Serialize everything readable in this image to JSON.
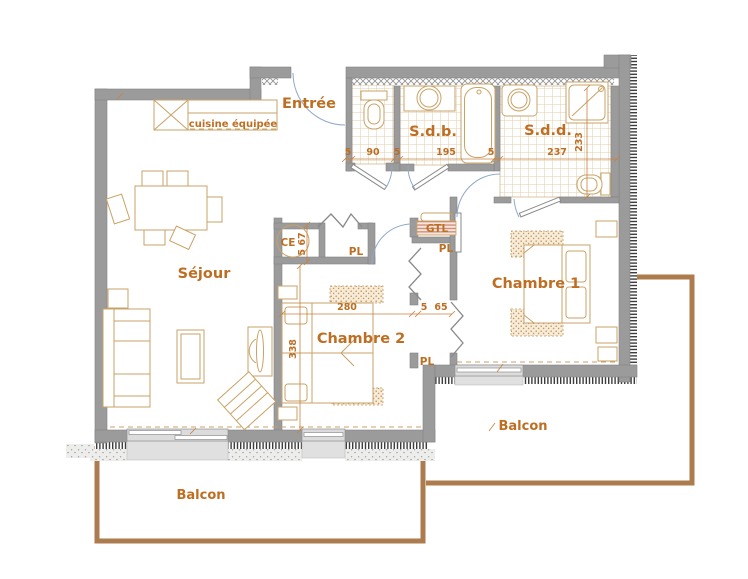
{
  "plan_type": "apartment-floor-plan",
  "colors": {
    "wall": "#9B9B9B",
    "label_text": "#BE6E22",
    "furniture_line": "#C9A265",
    "balcony_line": "#AC7C4E",
    "door_arc": "#8FA8CC",
    "tile_line": "#E3CDAA",
    "window_fill": "#DCDCDC"
  },
  "labels": {
    "entree": "Entrée",
    "sdb": "S.d.b.",
    "sdd": "S.d.d.",
    "sejour": "Séjour",
    "chambre1": "Chambre 1",
    "chambre2": "Chambre 2",
    "balcon_south": "Balcon",
    "balcon_east": "Balcon",
    "kitchen": "cuisine équipée",
    "ce": "CE",
    "gtl": "GTL",
    "pl_hall": "PL",
    "pl_mid": "PL",
    "pl_low": "PL"
  },
  "dimensions_cm": {
    "wc": [
      "5",
      "90",
      "5"
    ],
    "sdb_width": "195",
    "sdb_sdd_wall": "5",
    "sdd_width": "237",
    "sdd_depth": "233",
    "chambre2_width": "280",
    "chambre2_depth": "338",
    "ce_depth": "5 67",
    "closet_wall": "5",
    "closet_width": "65"
  }
}
